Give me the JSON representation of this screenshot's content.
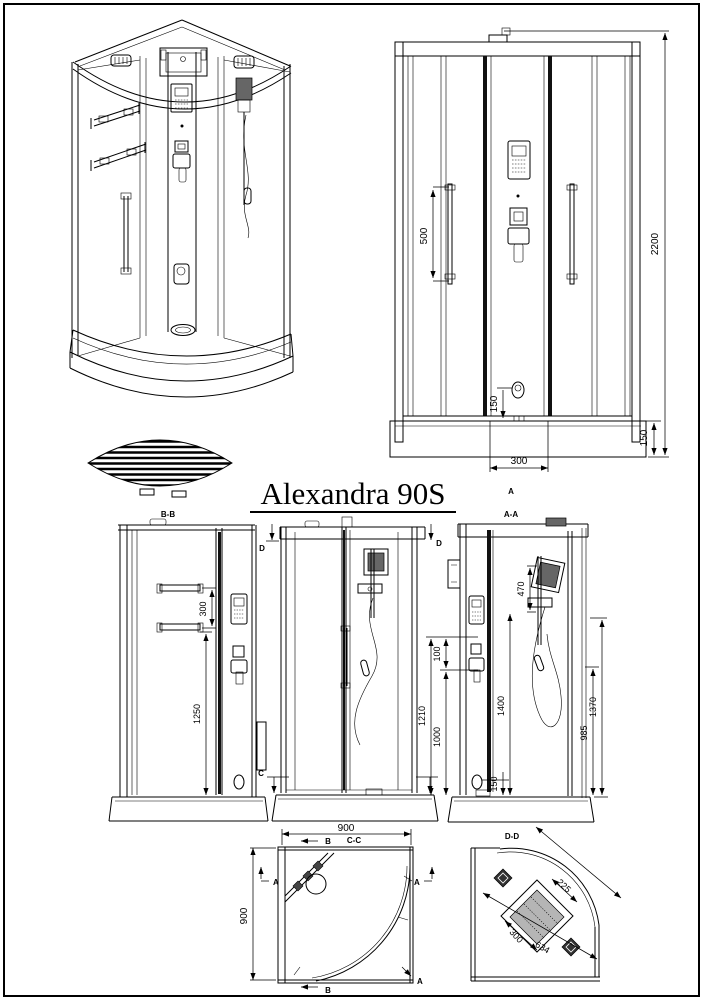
{
  "page": {
    "title": "Alexandra 90S"
  },
  "front_view": {
    "dim_rail": "500",
    "dim_height": "2200",
    "dim_drain": "150",
    "dim_door": "300",
    "dim_tray": "150",
    "marker_a": "A"
  },
  "side_view_bb": {
    "label": "B-B",
    "dim_shelf_gap": "300",
    "dim_shelf_height": "1250"
  },
  "back_view": {
    "marker_d_left": "D",
    "marker_d_right": "D",
    "marker_c_left": "C"
  },
  "side_view_aa": {
    "label": "A-A",
    "dim_holder": "470",
    "dim_gap": "100",
    "dim_panel": "1210",
    "dim_mixer": "1000",
    "dim_rail": "1400",
    "dim_drain": "150",
    "dim_glass": "985",
    "dim_door": "1370"
  },
  "plan_cc": {
    "label": "C-C",
    "dim_width": "900",
    "dim_depth": "900",
    "marker_b_top": "B",
    "marker_b_bottom": "B",
    "marker_a_left": "A",
    "marker_a_right": "A",
    "marker_a_corner": "A"
  },
  "plan_dd": {
    "label": "D-D",
    "dim_diagonal": "634",
    "dim_panel": "300",
    "dim_offset": "225"
  }
}
